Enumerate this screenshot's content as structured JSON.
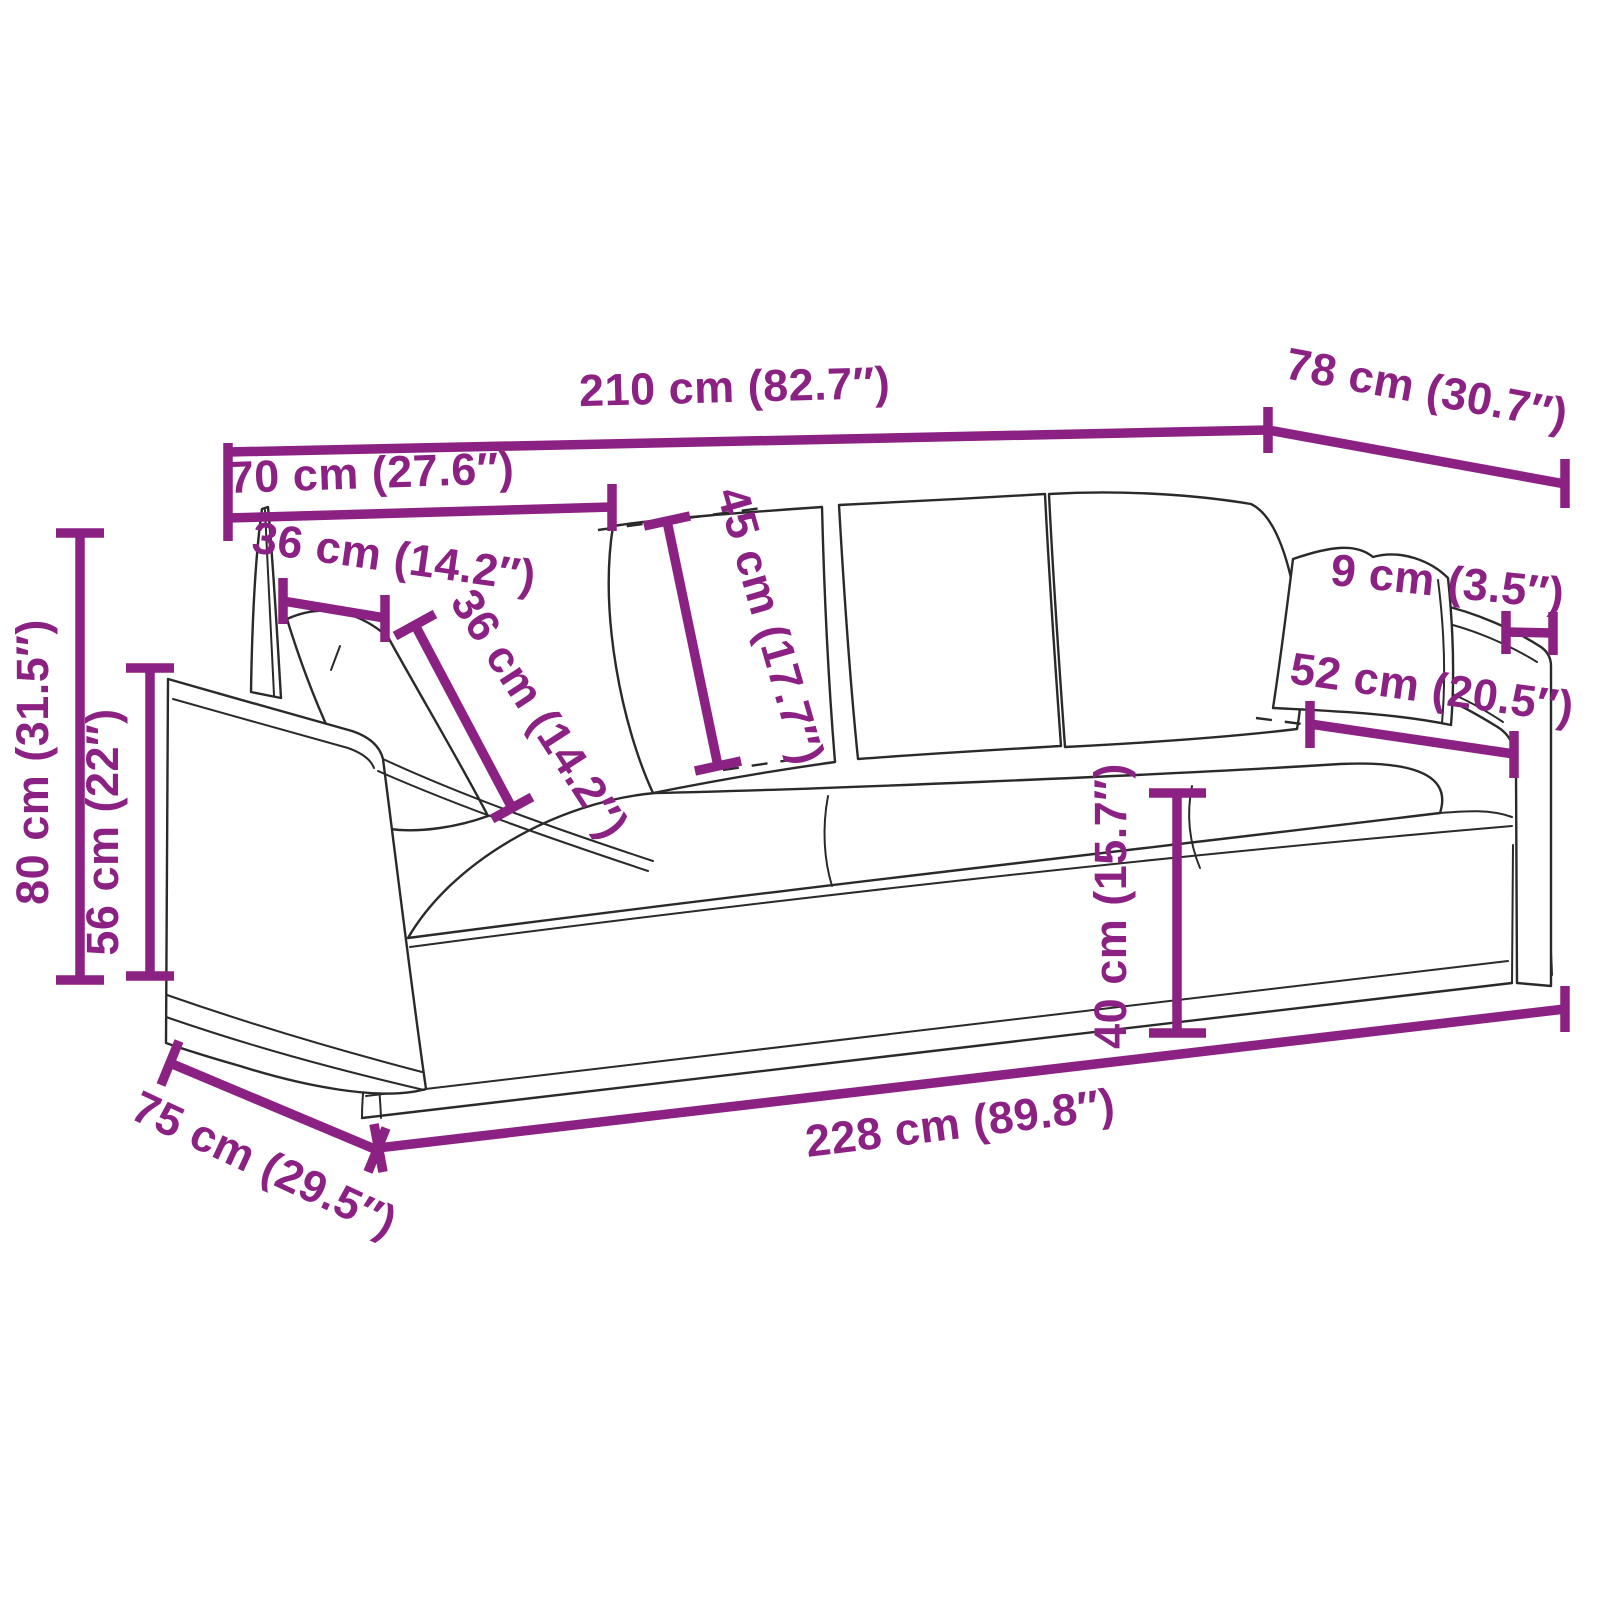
{
  "diagram": {
    "type": "product-dimension-diagram",
    "subject": "3-seater skirted sofa with back cushions and throw pillows",
    "unit_primary": "cm",
    "unit_secondary": "inch"
  },
  "colors": {
    "dimension": "#8c2184",
    "outline": "#2a2a2a",
    "background": "#ffffff"
  },
  "dimensions": {
    "top_width": {
      "label": "210 cm (82.7″)",
      "cm": 210,
      "inch": 82.7
    },
    "top_depth": {
      "label": "78 cm (30.7″)",
      "cm": 78,
      "inch": 30.7
    },
    "arm_section_width": {
      "label": "70 cm (27.6″)",
      "cm": 70,
      "inch": 27.6
    },
    "pillow_width": {
      "label": "36 cm (14.2″)",
      "cm": 36,
      "inch": 14.2
    },
    "pillow_height": {
      "label": "36 cm (14.2″)",
      "cm": 36,
      "inch": 14.2
    },
    "back_cushion_height": {
      "label": "45 cm (17.7″)",
      "cm": 45,
      "inch": 17.7
    },
    "overall_height": {
      "label": "80 cm (31.5″)",
      "cm": 80,
      "inch": 31.5
    },
    "arm_height": {
      "label": "56 cm (22″)",
      "cm": 56,
      "inch": 22
    },
    "seat_height": {
      "label": "40 cm (15.7″)",
      "cm": 40,
      "inch": 15.7
    },
    "base_width": {
      "label": "228 cm (89.8″)",
      "cm": 228,
      "inch": 89.8
    },
    "base_depth": {
      "label": "75 cm (29.5″)",
      "cm": 75,
      "inch": 29.5
    },
    "armrest_width": {
      "label": "9 cm (3.5″)",
      "cm": 9,
      "inch": 3.5
    },
    "armrest_pillow_width": {
      "label": "52 cm (20.5″)",
      "cm": 52,
      "inch": 20.5
    }
  }
}
